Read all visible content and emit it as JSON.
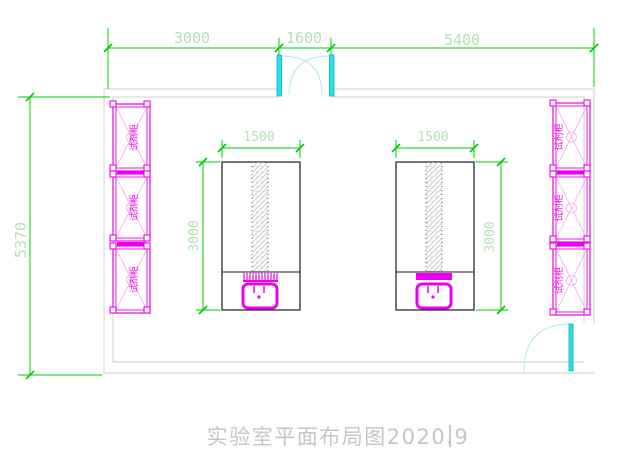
{
  "canvas": {
    "width": 619,
    "height": 469
  },
  "title": {
    "text": "实验室平面布局图2020.9"
  },
  "dimensions": {
    "top": [
      {
        "label": "3000"
      },
      {
        "label": "1600"
      },
      {
        "label": "5400"
      }
    ],
    "left": {
      "label": "5370"
    },
    "bench_width": {
      "label": "1500"
    },
    "bench_depth": {
      "label": "3000"
    }
  },
  "cabinets": {
    "label": "试剂柜",
    "left_count": 3,
    "right_count": 3
  },
  "equipment": {
    "bench_count": 2,
    "sink_count": 2
  },
  "doors": {
    "top_double_door": "1600",
    "right_single_door": true
  },
  "colors": {
    "dimension_line": "#00cc00",
    "dimension_text": "#b2e3b2",
    "cabinet": "#ee00ee",
    "cabinet_light": "#f3a6ee",
    "door": "#2bdfe8",
    "door_arc": "#bfe9ee",
    "wall": "#cfcfcf",
    "bench_outline": "#1a1a1a",
    "title_text": "#c6c6c6"
  }
}
